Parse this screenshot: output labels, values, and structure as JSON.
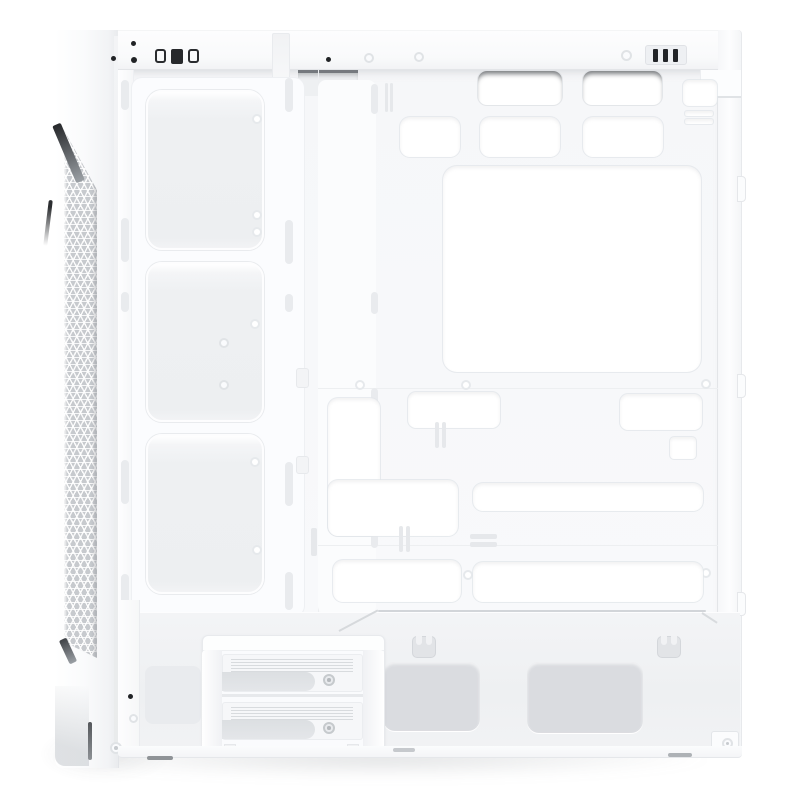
{
  "meta": {
    "subject": "White mid-tower PC case with left side panel removed, interior side view",
    "visible_text": ""
  },
  "colors": {
    "bg": "#ffffff",
    "case_white": "#fbfcfd",
    "panel_grey": "#f1f2f4",
    "recess_grey": "#eceef1",
    "vent_grey": "#dadce0",
    "mesh_grey": "#c7cace",
    "seam_grey": "#e6e8eb",
    "dark_accent": "#212326",
    "shadow_grey": "#d9dce0"
  },
  "parts": {
    "front_panel": {
      "mesh_style": "triangular lattice strip",
      "dark_wedge_accents": 2,
      "edge_accents": 1
    },
    "top_panel": {
      "black_screws": 5,
      "light_screws": 4,
      "io_cutouts": 2,
      "io_connector_bars": 3
    },
    "fan_bracket": {
      "fan_bays": 3,
      "rail_mount_slots": 10,
      "screw_holes": 6,
      "ring_holes": 2
    },
    "motherboard_tray": {
      "cpu_cooler_cutout": 1,
      "top_cable_grommets": 2,
      "cable_cutouts": 11,
      "cable_tie_slot_pairs": 4,
      "standoff_holes": 6,
      "rear_vent_slots": 2
    },
    "rear_panel": {
      "side_panel_tabs": 3,
      "latch_slots": 2
    },
    "psu_shroud": {
      "mesh_vents": 2,
      "cable_clips": 2
    },
    "drive_cage": {
      "drive_trays": 2,
      "thumbscrews": 2,
      "side_recess_panels": 1
    },
    "bottom": {
      "foot_marks": 3,
      "corner_screws": 2
    }
  }
}
